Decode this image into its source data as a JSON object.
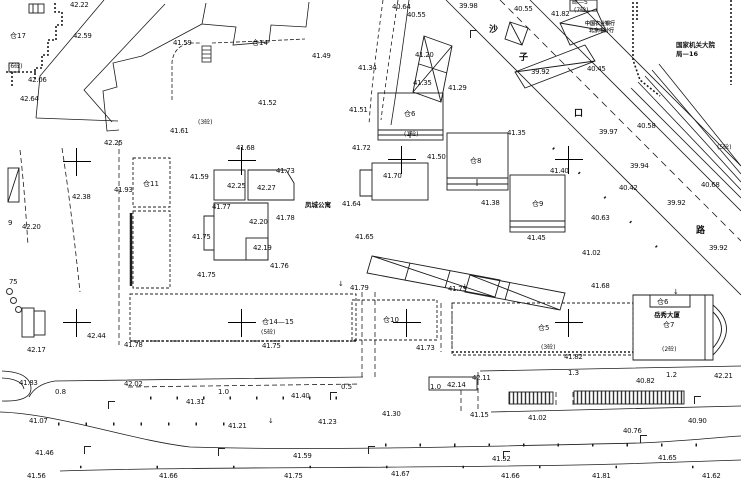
{
  "map": {
    "kind": "cadastral-topographic-survey-plan",
    "colors": {
      "background": "#ffffff",
      "line": "#1c1c1c",
      "text": "#111111"
    },
    "street_name_chars": [
      {
        "t": "沙",
        "x": 489,
        "y": 26
      },
      {
        "t": "子",
        "x": 519,
        "y": 54
      },
      {
        "t": "口",
        "x": 574,
        "y": 110
      },
      {
        "t": "路",
        "x": 696,
        "y": 227
      }
    ],
    "labels": [
      {
        "t": "42.22",
        "x": 70,
        "y": 2,
        "k": "elev"
      },
      {
        "t": "42.59",
        "x": 73,
        "y": 33,
        "k": "elev"
      },
      {
        "t": "41.59",
        "x": 173,
        "y": 40,
        "k": "elev"
      },
      {
        "t": "42.06",
        "x": 28,
        "y": 77,
        "k": "elev"
      },
      {
        "t": "42.64",
        "x": 20,
        "y": 96,
        "k": "elev"
      },
      {
        "t": "42.25",
        "x": 104,
        "y": 140,
        "k": "elev"
      },
      {
        "t": "41.61",
        "x": 170,
        "y": 128,
        "k": "elev"
      },
      {
        "t": "41.49",
        "x": 312,
        "y": 53,
        "k": "elev"
      },
      {
        "t": "41.52",
        "x": 258,
        "y": 100,
        "k": "elev"
      },
      {
        "t": "41.51",
        "x": 349,
        "y": 107,
        "k": "elev"
      },
      {
        "t": "40.64",
        "x": 392,
        "y": 4,
        "k": "elev"
      },
      {
        "t": "40.55",
        "x": 407,
        "y": 12,
        "k": "elev"
      },
      {
        "t": "39.98",
        "x": 459,
        "y": 3,
        "k": "elev"
      },
      {
        "t": "41.34",
        "x": 358,
        "y": 65,
        "k": "elev"
      },
      {
        "t": "41.20",
        "x": 415,
        "y": 52,
        "k": "elev"
      },
      {
        "t": "41.35",
        "x": 413,
        "y": 80,
        "k": "elev"
      },
      {
        "t": "41.29",
        "x": 448,
        "y": 85,
        "k": "elev"
      },
      {
        "t": "40.55",
        "x": 514,
        "y": 6,
        "k": "elev"
      },
      {
        "t": "41.82",
        "x": 551,
        "y": 11,
        "k": "elev"
      },
      {
        "t": "40.45",
        "x": 587,
        "y": 66,
        "k": "elev"
      },
      {
        "t": "39.92",
        "x": 531,
        "y": 69,
        "k": "elev"
      },
      {
        "t": "40.58",
        "x": 637,
        "y": 123,
        "k": "elev"
      },
      {
        "t": "39.97",
        "x": 599,
        "y": 129,
        "k": "elev"
      },
      {
        "t": "41.35",
        "x": 507,
        "y": 130,
        "k": "elev"
      },
      {
        "t": "39.94",
        "x": 630,
        "y": 163,
        "k": "elev"
      },
      {
        "t": "40.42",
        "x": 619,
        "y": 185,
        "k": "elev"
      },
      {
        "t": "39.92",
        "x": 667,
        "y": 200,
        "k": "elev"
      },
      {
        "t": "40.68",
        "x": 701,
        "y": 182,
        "k": "elev"
      },
      {
        "t": "40.63",
        "x": 591,
        "y": 215,
        "k": "elev"
      },
      {
        "t": "39.92",
        "x": 709,
        "y": 245,
        "k": "elev"
      },
      {
        "t": "41.02",
        "x": 582,
        "y": 250,
        "k": "elev"
      },
      {
        "t": "41.68",
        "x": 591,
        "y": 283,
        "k": "elev"
      },
      {
        "t": "41.93",
        "x": 114,
        "y": 187,
        "k": "elev"
      },
      {
        "t": "42.38",
        "x": 72,
        "y": 194,
        "k": "elev"
      },
      {
        "t": "42.20",
        "x": 22,
        "y": 224,
        "k": "elev"
      },
      {
        "t": "9",
        "x": 8,
        "y": 220,
        "k": "elev"
      },
      {
        "t": "75",
        "x": 9,
        "y": 279,
        "k": "elev"
      },
      {
        "t": "41.68",
        "x": 236,
        "y": 145,
        "k": "elev"
      },
      {
        "t": "41.73",
        "x": 276,
        "y": 168,
        "k": "elev"
      },
      {
        "t": "41.59",
        "x": 190,
        "y": 174,
        "k": "elev"
      },
      {
        "t": "42.25",
        "x": 227,
        "y": 183,
        "k": "elev"
      },
      {
        "t": "42.27",
        "x": 257,
        "y": 185,
        "k": "elev"
      },
      {
        "t": "41.77",
        "x": 212,
        "y": 204,
        "k": "elev"
      },
      {
        "t": "42.20",
        "x": 249,
        "y": 219,
        "k": "elev"
      },
      {
        "t": "41.78",
        "x": 276,
        "y": 215,
        "k": "elev"
      },
      {
        "t": "41.75",
        "x": 192,
        "y": 234,
        "k": "elev"
      },
      {
        "t": "42.19",
        "x": 253,
        "y": 245,
        "k": "elev"
      },
      {
        "t": "41.76",
        "x": 270,
        "y": 263,
        "k": "elev"
      },
      {
        "t": "41.75",
        "x": 197,
        "y": 272,
        "k": "elev"
      },
      {
        "t": "41.72",
        "x": 352,
        "y": 145,
        "k": "elev"
      },
      {
        "t": "41.64",
        "x": 342,
        "y": 201,
        "k": "elev"
      },
      {
        "t": "41.65",
        "x": 355,
        "y": 234,
        "k": "elev"
      },
      {
        "t": "41.70",
        "x": 383,
        "y": 173,
        "k": "elev"
      },
      {
        "t": "41.50",
        "x": 427,
        "y": 154,
        "k": "elev"
      },
      {
        "t": "41.38",
        "x": 481,
        "y": 200,
        "k": "elev"
      },
      {
        "t": "41.40",
        "x": 550,
        "y": 168,
        "k": "elev"
      },
      {
        "t": "41.45",
        "x": 527,
        "y": 235,
        "k": "elev"
      },
      {
        "t": "42.44",
        "x": 87,
        "y": 333,
        "k": "elev"
      },
      {
        "t": "42.17",
        "x": 27,
        "y": 347,
        "k": "elev"
      },
      {
        "t": "41.78",
        "x": 124,
        "y": 342,
        "k": "elev"
      },
      {
        "t": "41.83",
        "x": 19,
        "y": 380,
        "k": "elev"
      },
      {
        "t": "42.02",
        "x": 124,
        "y": 381,
        "k": "elev"
      },
      {
        "t": "41.79",
        "x": 350,
        "y": 285,
        "k": "elev"
      },
      {
        "t": "41.75",
        "x": 448,
        "y": 286,
        "k": "elev"
      },
      {
        "t": "41.75",
        "x": 262,
        "y": 343,
        "k": "elev"
      },
      {
        "t": "41.73",
        "x": 416,
        "y": 345,
        "k": "elev"
      },
      {
        "t": "42.14",
        "x": 447,
        "y": 382,
        "k": "elev"
      },
      {
        "t": "42.11",
        "x": 472,
        "y": 375,
        "k": "elev"
      },
      {
        "t": "41.82",
        "x": 564,
        "y": 354,
        "k": "elev"
      },
      {
        "t": "42.21",
        "x": 714,
        "y": 373,
        "k": "elev"
      },
      {
        "t": "40.82",
        "x": 636,
        "y": 378,
        "k": "elev"
      },
      {
        "t": "41.31",
        "x": 186,
        "y": 399,
        "k": "elev"
      },
      {
        "t": "41.07",
        "x": 29,
        "y": 418,
        "k": "elev"
      },
      {
        "t": "41.21",
        "x": 228,
        "y": 423,
        "k": "elev"
      },
      {
        "t": "41.46",
        "x": 35,
        "y": 450,
        "k": "elev"
      },
      {
        "t": "41.56",
        "x": 27,
        "y": 473,
        "k": "elev"
      },
      {
        "t": "41.66",
        "x": 159,
        "y": 473,
        "k": "elev"
      },
      {
        "t": "41.40",
        "x": 291,
        "y": 393,
        "k": "elev"
      },
      {
        "t": "41.23",
        "x": 318,
        "y": 419,
        "k": "elev"
      },
      {
        "t": "41.30",
        "x": 382,
        "y": 411,
        "k": "elev"
      },
      {
        "t": "41.15",
        "x": 470,
        "y": 412,
        "k": "elev"
      },
      {
        "t": "41.59",
        "x": 293,
        "y": 453,
        "k": "elev"
      },
      {
        "t": "41.75",
        "x": 284,
        "y": 473,
        "k": "elev"
      },
      {
        "t": "41.67",
        "x": 391,
        "y": 471,
        "k": "elev"
      },
      {
        "t": "41.02",
        "x": 528,
        "y": 415,
        "k": "elev"
      },
      {
        "t": "40.90",
        "x": 688,
        "y": 418,
        "k": "elev"
      },
      {
        "t": "40.76",
        "x": 623,
        "y": 428,
        "k": "elev"
      },
      {
        "t": "41.52",
        "x": 492,
        "y": 456,
        "k": "elev"
      },
      {
        "t": "41.65",
        "x": 658,
        "y": 455,
        "k": "elev"
      },
      {
        "t": "41.66",
        "x": 501,
        "y": 473,
        "k": "elev"
      },
      {
        "t": "41.81",
        "x": 592,
        "y": 473,
        "k": "elev"
      },
      {
        "t": "41.62",
        "x": 702,
        "y": 473,
        "k": "elev"
      },
      {
        "t": "仓17",
        "x": 10,
        "y": 33,
        "k": "bldg"
      },
      {
        "t": "仓14",
        "x": 252,
        "y": 40,
        "k": "bldg"
      },
      {
        "t": "仓11",
        "x": 143,
        "y": 181,
        "k": "bldg"
      },
      {
        "t": "仓6",
        "x": 404,
        "y": 111,
        "k": "bldg"
      },
      {
        "t": "仓8",
        "x": 470,
        "y": 158,
        "k": "bldg"
      },
      {
        "t": "仓9",
        "x": 532,
        "y": 201,
        "k": "bldg"
      },
      {
        "t": "仓14—15",
        "x": 262,
        "y": 319,
        "k": "bldg"
      },
      {
        "t": "仓10",
        "x": 383,
        "y": 317,
        "k": "bldg"
      },
      {
        "t": "仓5",
        "x": 538,
        "y": 325,
        "k": "bldg"
      },
      {
        "t": "仓6",
        "x": 657,
        "y": 299,
        "k": "bldg"
      },
      {
        "t": "仓7",
        "x": 663,
        "y": 322,
        "k": "bldg"
      },
      {
        "t": "(6砼)",
        "x": 8,
        "y": 64,
        "k": "anno"
      },
      {
        "t": "(7砼)",
        "x": 574,
        "y": 8,
        "k": "anno"
      },
      {
        "t": "邮—5",
        "x": 572,
        "y": 0,
        "k": "anno"
      },
      {
        "t": "(3砼)",
        "x": 198,
        "y": 120,
        "k": "anno"
      },
      {
        "t": "(1砼)",
        "x": 404,
        "y": 132,
        "k": "anno"
      },
      {
        "t": "(5砼)",
        "x": 717,
        "y": 145,
        "k": "anno"
      },
      {
        "t": "(5砼)",
        "x": 261,
        "y": 330,
        "k": "anno"
      },
      {
        "t": "(3砼)",
        "x": 541,
        "y": 345,
        "k": "anno"
      },
      {
        "t": "(2砼)",
        "x": 662,
        "y": 347,
        "k": "anno"
      },
      {
        "t": "凤城公寓",
        "x": 305,
        "y": 202,
        "k": "place"
      },
      {
        "t": "岳秀大厦",
        "x": 654,
        "y": 312,
        "k": "place"
      },
      {
        "t": "国家机关大院",
        "x": 676,
        "y": 42,
        "k": "place"
      },
      {
        "t": "局—16",
        "x": 676,
        "y": 51,
        "k": "place"
      },
      {
        "t": "中国农业银行",
        "x": 585,
        "y": 22,
        "k": "place-sm"
      },
      {
        "t": "北京市分行",
        "x": 589,
        "y": 29,
        "k": "place-sm"
      },
      {
        "t": "0.8",
        "x": 55,
        "y": 389,
        "k": "dist"
      },
      {
        "t": "1.0",
        "x": 218,
        "y": 389,
        "k": "dist"
      },
      {
        "t": "0.5",
        "x": 341,
        "y": 384,
        "k": "dist"
      },
      {
        "t": "1.0",
        "x": 430,
        "y": 384,
        "k": "dist"
      },
      {
        "t": "1.3",
        "x": 568,
        "y": 370,
        "k": "dist"
      },
      {
        "t": "1.2",
        "x": 666,
        "y": 372,
        "k": "dist"
      }
    ],
    "grid_crosses": [
      {
        "x": 77,
        "y": 162
      },
      {
        "x": 242,
        "y": 161
      },
      {
        "x": 402,
        "y": 160
      },
      {
        "x": 569,
        "y": 160
      },
      {
        "x": 77,
        "y": 323
      },
      {
        "x": 242,
        "y": 323
      },
      {
        "x": 407,
        "y": 323
      },
      {
        "x": 569,
        "y": 323
      }
    ],
    "lamps": [
      {
        "x": 470,
        "y": 30
      },
      {
        "x": 108,
        "y": 401
      },
      {
        "x": 330,
        "y": 392
      },
      {
        "x": 84,
        "y": 446
      },
      {
        "x": 218,
        "y": 448
      },
      {
        "x": 368,
        "y": 446
      },
      {
        "x": 503,
        "y": 451
      },
      {
        "x": 694,
        "y": 396
      },
      {
        "x": 640,
        "y": 435
      }
    ],
    "arrows": [
      {
        "x": 338,
        "y": 281
      },
      {
        "x": 462,
        "y": 284
      },
      {
        "x": 268,
        "y": 418
      },
      {
        "x": 673,
        "y": 289
      }
    ],
    "trees": [
      {
        "x": 6,
        "y": 288
      },
      {
        "x": 10,
        "y": 297
      },
      {
        "x": 15,
        "y": 306
      }
    ],
    "arrow_glyph": "↓"
  }
}
